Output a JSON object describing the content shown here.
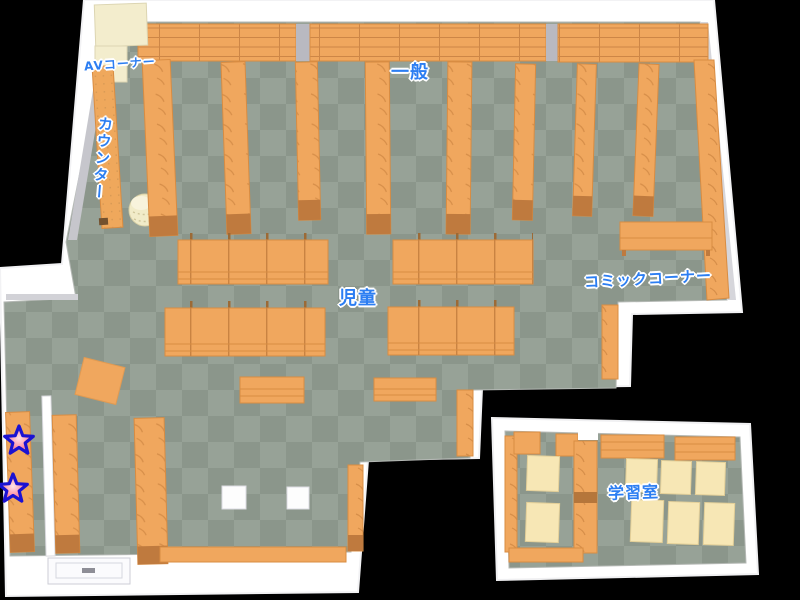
{
  "map": {
    "labels": {
      "av_corner": "AVコーナー",
      "general": "一般",
      "counter": "カウンター",
      "children": "児童",
      "comic_corner": "コミックコーナー",
      "study_room": "学習室"
    },
    "markers": [
      {
        "name": "star-marker-1",
        "shape": "star"
      },
      {
        "name": "star-marker-2",
        "shape": "star"
      }
    ],
    "colors": {
      "background": "#000000",
      "wall": "#ffffff",
      "wall_shade": "#c6c6cc",
      "floor_light": "#97a297",
      "floor_dark": "#8b968b",
      "shelf": "#f0a75e",
      "shelf_edge": "#d88c42",
      "shelf_end": "#bf7a3e",
      "cream_shelf": "#f3edcd",
      "desk": "#f7e7b5",
      "label_blue": "#2c7ef2",
      "star_fill": "#ff8fa2",
      "star_outline": "#1b12d2"
    }
  }
}
